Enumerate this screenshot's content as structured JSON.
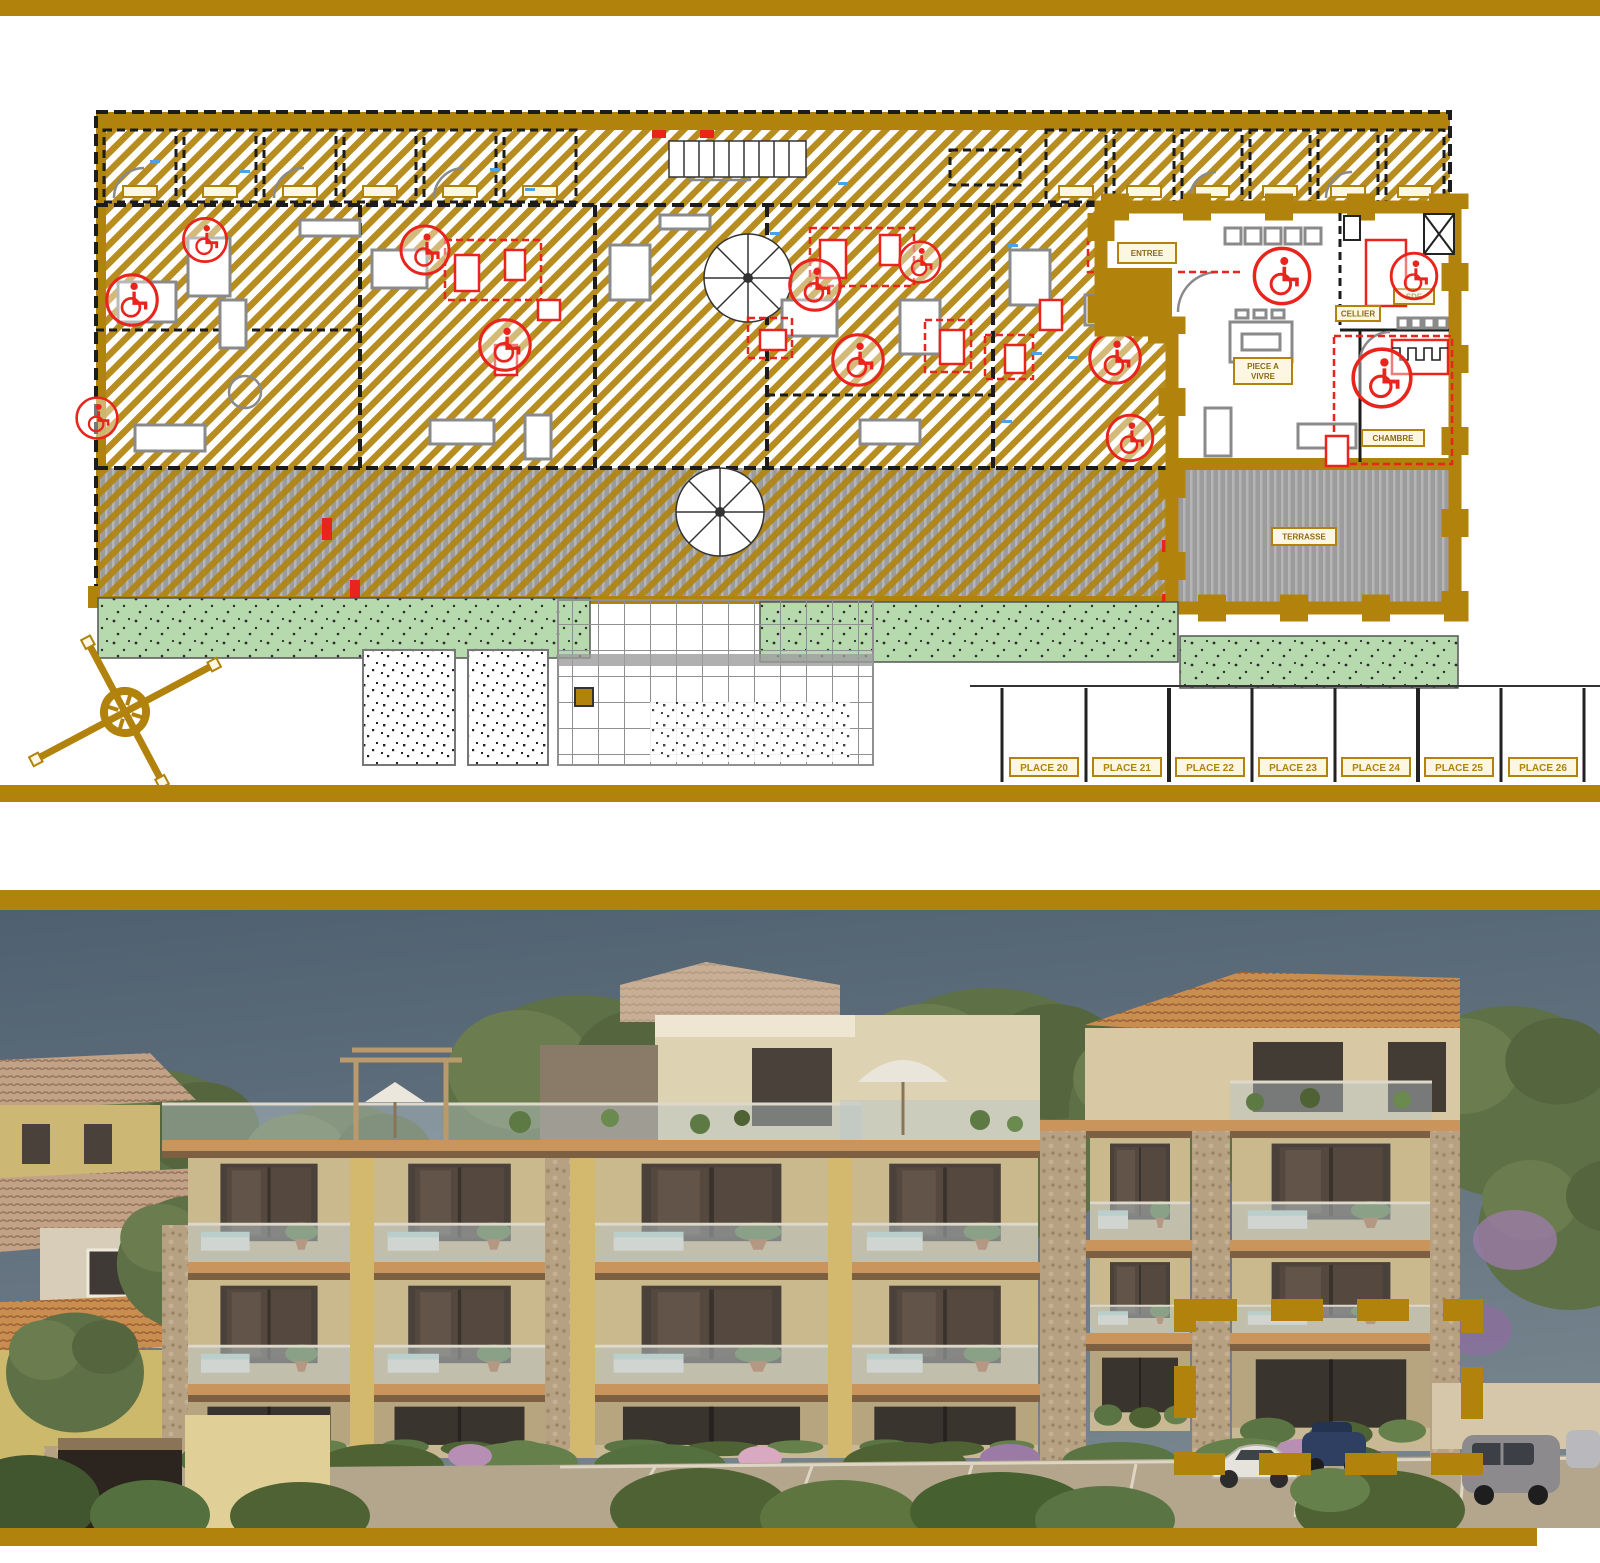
{
  "colors": {
    "accent_gold": "#B1830D",
    "plan_wall_black": "#1c1c1c",
    "accessibility_red": "#E8241C",
    "furniture_gray": "#8a8a8a",
    "dimension_blue": "#4aa3e8",
    "lawn_green": "#b7d9ae",
    "terrace_gray": "#9c9c9c",
    "sky_blue_gray": "#5d6e7b",
    "foliage_green": "#5d7046",
    "building_beige": "#d5c49c",
    "penthouse_cream": "#ddd2b2",
    "slab_fascia": "#c9955c",
    "slab_wood_brown": "#7d5f41",
    "roof_tile_terracotta": "#c98e4f",
    "stone_pier": "#b7a183",
    "asphalt": "#b3a68c"
  },
  "floor_plan": {
    "parking": [
      {
        "label": "PLACE 20"
      },
      {
        "label": "PLACE 21"
      },
      {
        "label": "PLACE 22"
      },
      {
        "label": "PLACE 23"
      },
      {
        "label": "PLACE 24"
      },
      {
        "label": "PLACE 25"
      },
      {
        "label": "PLACE 26"
      }
    ],
    "unit": {
      "entree": "ENTREE",
      "piece_line1": "PIECE A",
      "piece_line2": "VIVRE",
      "cellier": "CELLIER",
      "sde": "SDE",
      "chambre": "CHAMBRE",
      "terrasse": "TERRASSE"
    }
  }
}
